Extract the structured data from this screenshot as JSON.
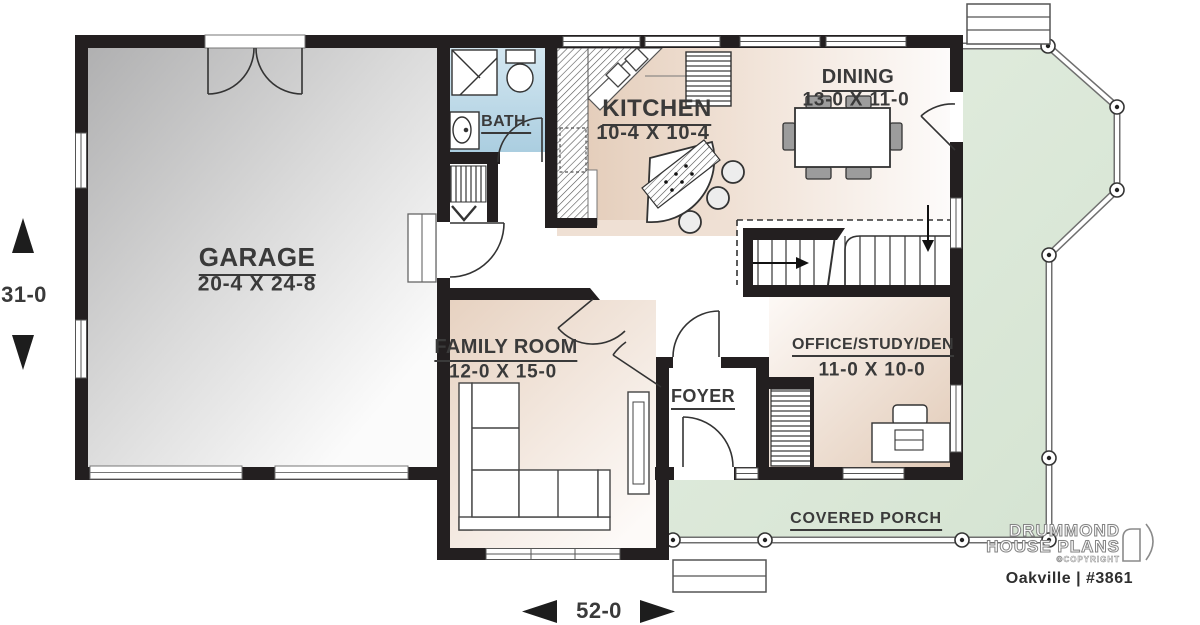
{
  "plan": {
    "rooms": {
      "garage": {
        "name": "GARAGE",
        "size": "20-4 X 24-8"
      },
      "bath": {
        "name": "BATH."
      },
      "kitchen": {
        "name": "KITCHEN",
        "size": "10-4 X 10-4"
      },
      "dining": {
        "name": "DINING",
        "size": "13-0 X 11-0"
      },
      "family_room": {
        "name": "FAMILY ROOM",
        "size": "12-0 X 15-0"
      },
      "foyer": {
        "name": "FOYER"
      },
      "office": {
        "name": "OFFICE/STUDY/DEN",
        "size": "11-0 X 10-0"
      },
      "covered_porch": {
        "name": "COVERED PORCH"
      }
    },
    "dimensions": {
      "overall_width": "52-0",
      "overall_depth": "31-0"
    },
    "branding": {
      "line1": "DRUMMOND",
      "line2": "HOUSE PLANS",
      "copyright": "©COPYRIGHT",
      "plan_id": "Oakville | #3861"
    },
    "colors": {
      "wall": "#231f20",
      "floor_beige": "#e5cfbe",
      "bath_blue": "#aecfe0",
      "porch_green": "#dde9da",
      "garage_gray": "#b5b5b5"
    }
  }
}
